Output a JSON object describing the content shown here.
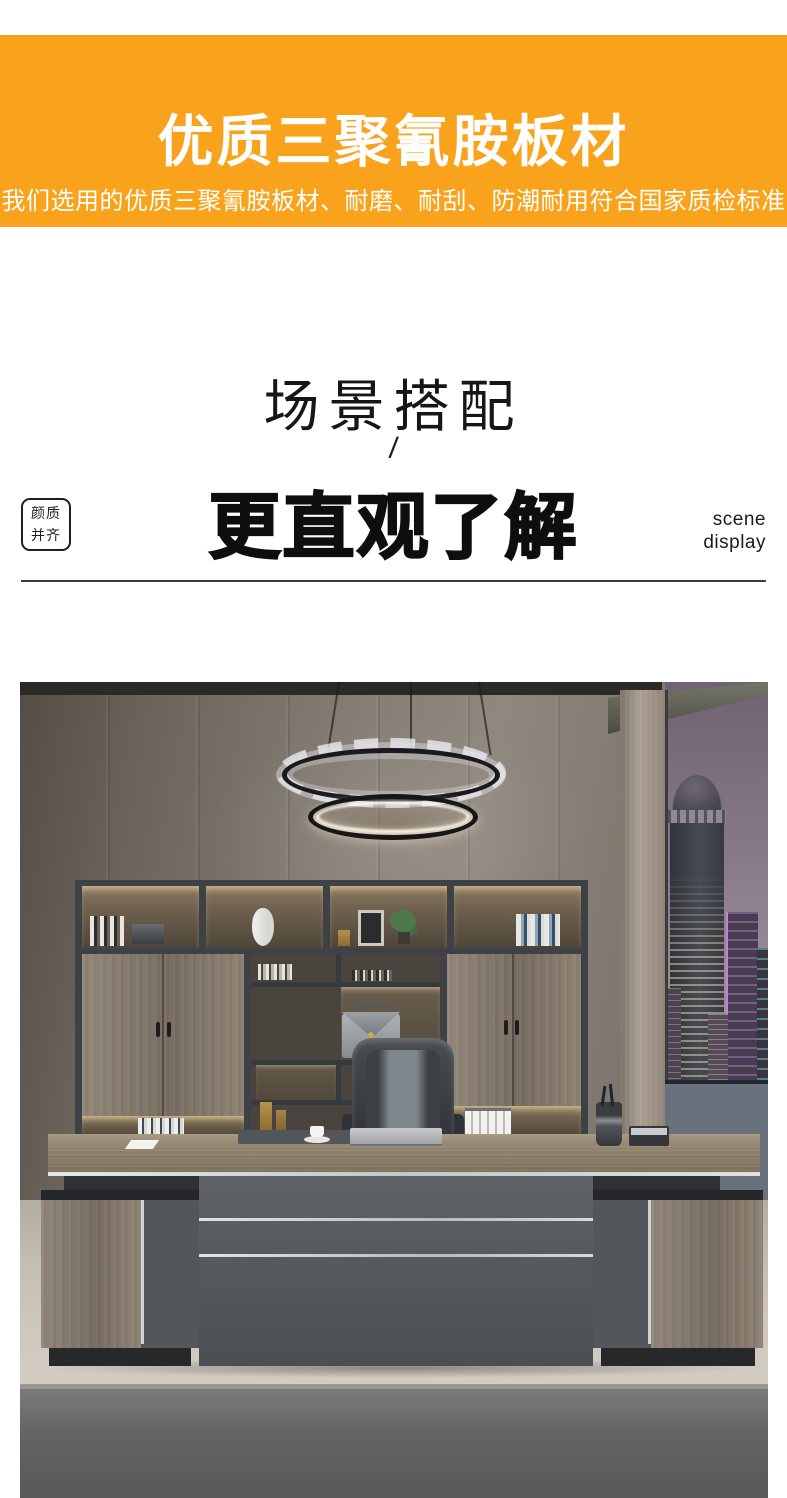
{
  "colors": {
    "accent_orange": "#F9A31C",
    "banner_text": "#FFFFFF"
  },
  "banner": {
    "title": "优质三聚氰胺板材",
    "subtitle": "我们选用的优质三聚氰胺板材、耐磨、耐刮、防潮耐用符合国家质检标准"
  },
  "scene_section": {
    "heading": "场景搭配",
    "divider_mark": "/",
    "subheading": "更直观了解",
    "badge": {
      "line1": "颜质",
      "line2": "并齐"
    },
    "side_label": {
      "line1": "scene",
      "line2": "display"
    }
  }
}
